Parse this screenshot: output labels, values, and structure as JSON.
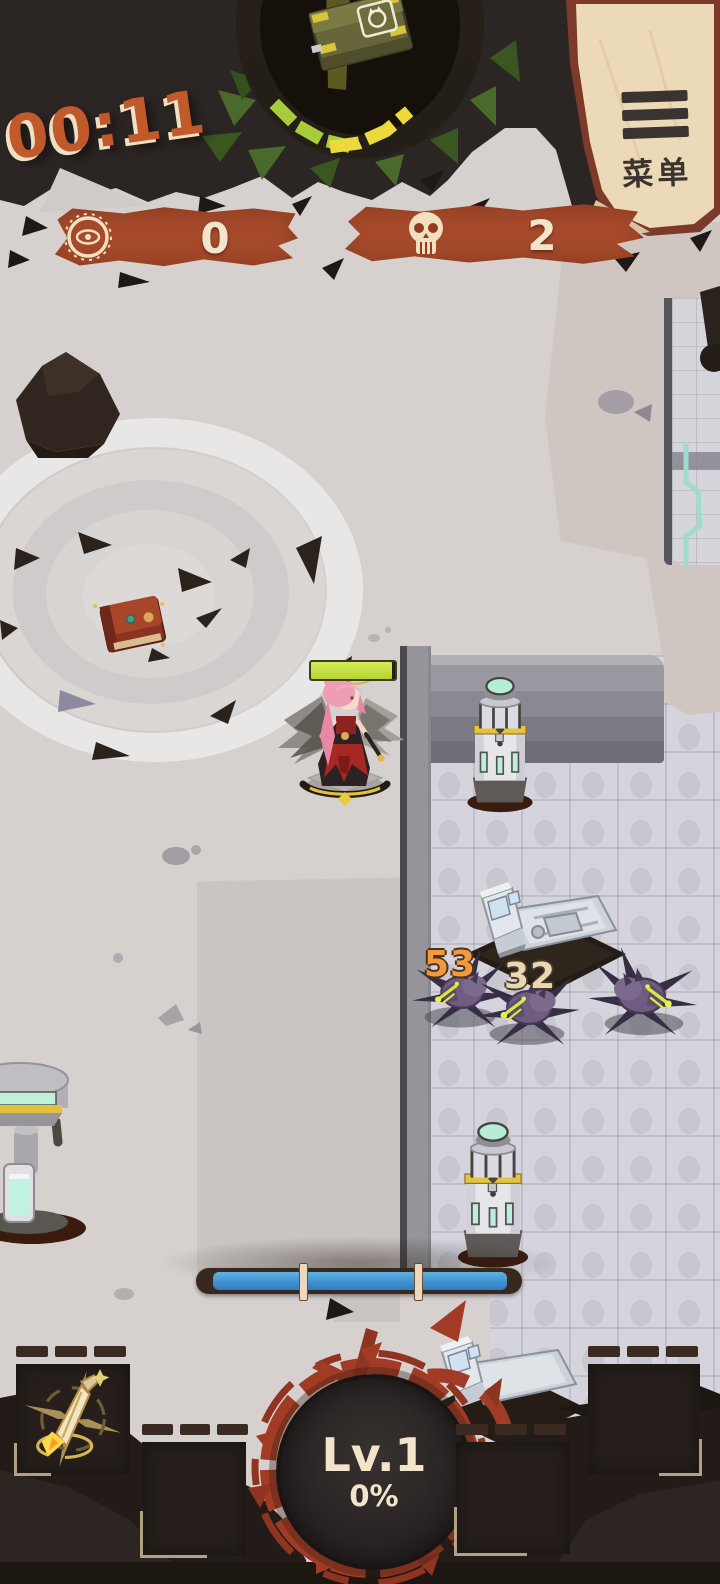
{
  "colors": {
    "timer_orange": "#c2592b",
    "banner_rust": "#a64a2b",
    "accent_red": "#a23b26",
    "parchment": "#ecd9b7",
    "hp_green": "#c6e03f",
    "xp_blue": "#3f8fd0",
    "supply_green": "#a9cc3c",
    "supply_yellow": "#ecd93e",
    "cream": "#f3e5cb"
  },
  "hud": {
    "timer": "00:11",
    "menu": {
      "label": "菜单",
      "icon": "hamburger-icon"
    },
    "counters": {
      "currency": {
        "icon": "eye-coin-icon",
        "value": "0"
      },
      "kills": {
        "icon": "skull-icon",
        "value": "2"
      }
    },
    "supply_drop": {
      "icon": "ammo-crate-icon"
    },
    "level": {
      "label": "Lv.1",
      "percent": "0%"
    },
    "xp_bar": {
      "segments": 3
    },
    "skill_bar": {
      "slot1_icon": "golden-dagger-icon",
      "empty_slots": 3
    }
  },
  "battle": {
    "damage_numbers": [
      "53",
      "32"
    ],
    "player_hp_percent": 97
  }
}
